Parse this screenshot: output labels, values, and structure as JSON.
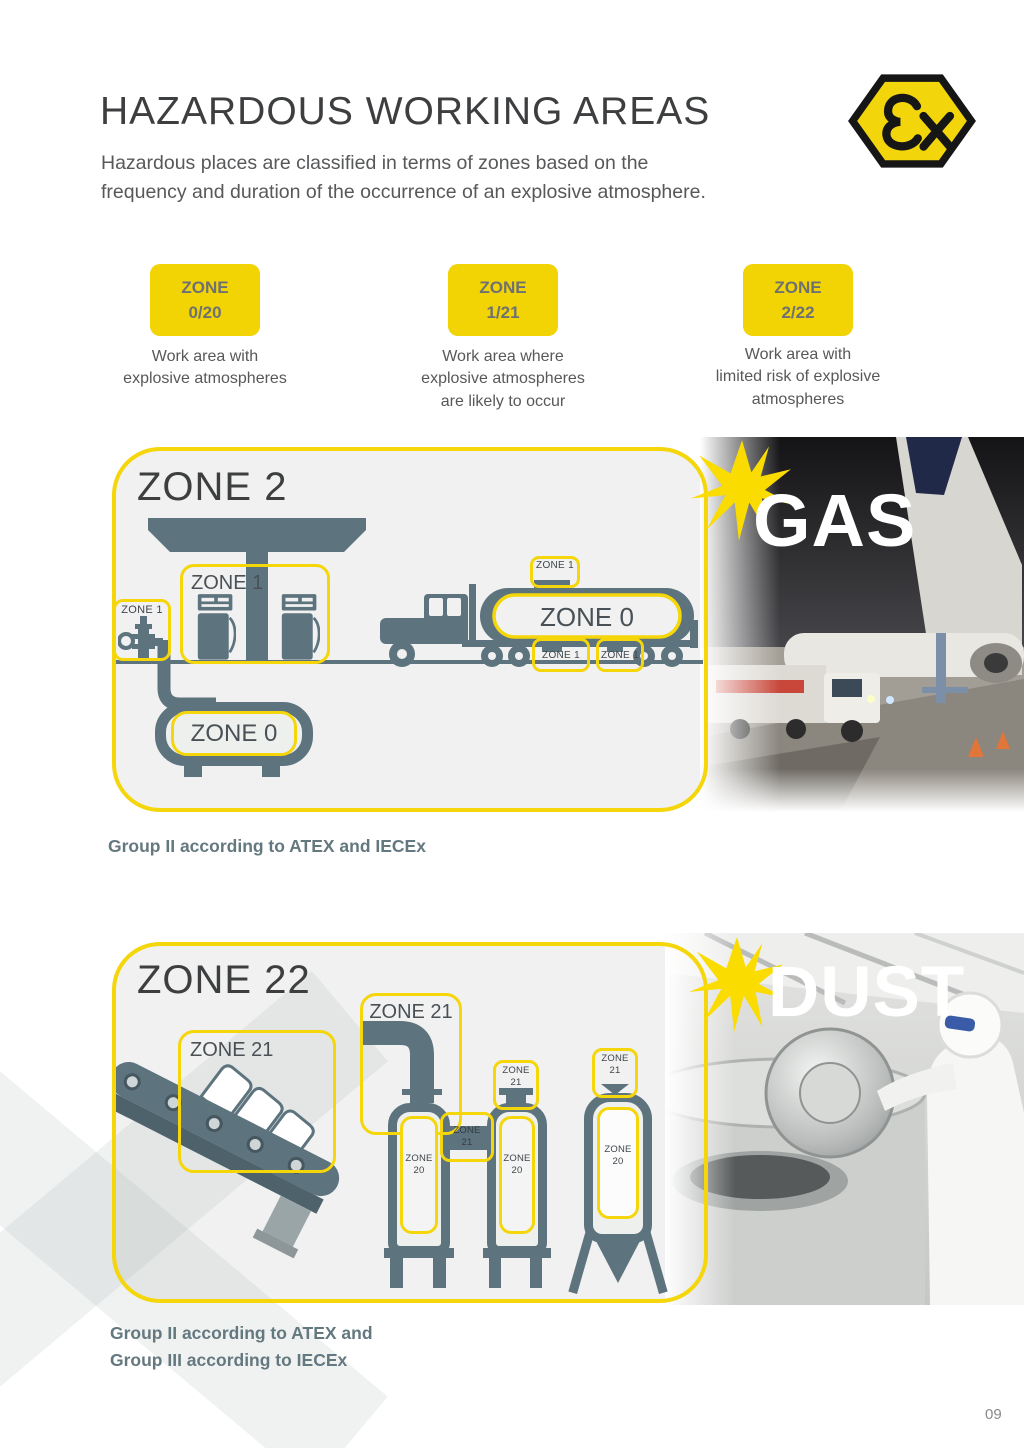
{
  "header": {
    "title": "HAZARDOUS WORKING AREAS",
    "subtitle": "Hazardous places are classified in terms of zones based on the\nfrequency and duration of the occurrence of an explosive atmosphere.",
    "ex_logo": "Ex-hexagon-mark"
  },
  "badges": [
    {
      "title": "ZONE",
      "value": "0/20",
      "description": "Work  area with\nexplosive atmospheres"
    },
    {
      "title": "ZONE",
      "value": "1/21",
      "description": "Work area where\nexplosive atmospheres\nare likely to occur"
    },
    {
      "title": "ZONE",
      "value": "2/22",
      "description": "Work area with\nlimited risk of explosive\natmospheres"
    }
  ],
  "gas_panel": {
    "title": "ZONE 2",
    "photo_label": "GAS",
    "caption": "Group II according to ATEX and IECEx",
    "labels": {
      "pumps": "ZONE 1",
      "wellhead": "ZONE 1",
      "underground_tank": "ZONE 0",
      "tanker_tank": "ZONE 0",
      "tanker_hatch": "ZONE 1",
      "tanker_outlet_left": "ZONE 1",
      "tanker_outlet_right": "ZONE 1"
    }
  },
  "dust_panel": {
    "title": "ZONE 22",
    "photo_label": "DUST",
    "caption": "Group II according to ATEX and\nGroup III according to IECEx",
    "labels": {
      "conveyor": "ZONE 21",
      "pipe": "ZONE 21",
      "silo1_interior": "ZONE\n20",
      "silo_connector": "ZONE\n21",
      "silo2_interior": "ZONE\n20",
      "silo2_top": "ZONE\n21",
      "hopper_interior": "ZONE\n20",
      "hopper_top": "ZONE\n21"
    }
  },
  "page_number": "09",
  "colors": {
    "accent_yellow": "#f4d60b",
    "icon_slate": "#5d737d",
    "title_gray": "#3d3e40",
    "body_gray": "#57585a",
    "caption_slate": "#64787f"
  }
}
